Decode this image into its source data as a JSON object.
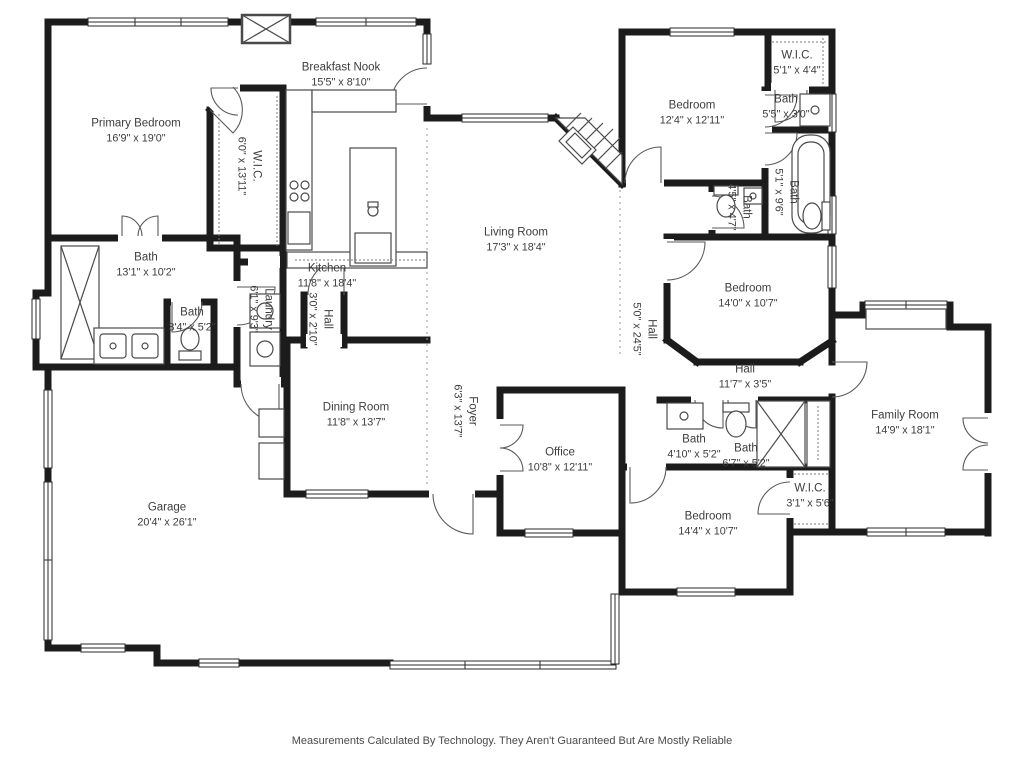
{
  "colors": {
    "background": "#ffffff",
    "walls": "#1c1c1c",
    "fixtures": "#4a4a4a",
    "text": "#3d3d3d"
  },
  "rooms": [
    {
      "name": "Primary Bedroom",
      "dims": "16'9\" x 19'0\"",
      "x": 136,
      "y": 131,
      "rotated": false
    },
    {
      "name": "W.I.C.",
      "dims": "6'0\" x 13'11\"",
      "x": 249,
      "y": 166,
      "rotated": true
    },
    {
      "name": "Breakfast Nook",
      "dims": "15'5\" x 8'10\"",
      "x": 341,
      "y": 75,
      "rotated": false
    },
    {
      "name": "Kitchen",
      "dims": "11'8\" x 18'4\"",
      "x": 327,
      "y": 276,
      "rotated": false
    },
    {
      "name": "Living Room",
      "dims": "17'3\" x 18'4\"",
      "x": 516,
      "y": 240,
      "rotated": false
    },
    {
      "name": "Bedroom",
      "dims": "12'4\" x 12'11\"",
      "x": 692,
      "y": 113,
      "rotated": false
    },
    {
      "name": "W.I.C.",
      "dims": "5'1\" x 4'4\"",
      "x": 797,
      "y": 63,
      "rotated": false
    },
    {
      "name": "Bath",
      "dims": "5'5\" x 3'0\"",
      "x": 786,
      "y": 107,
      "rotated": false
    },
    {
      "name": "Bath",
      "dims": "5'1\" x 9'6\"",
      "x": 786,
      "y": 192,
      "rotated": true
    },
    {
      "name": "Bath",
      "dims": "4'5\" x 4'7\"",
      "x": 739,
      "y": 207,
      "rotated": true
    },
    {
      "name": "Bedroom",
      "dims": "14'0\" x 10'7\"",
      "x": 748,
      "y": 296,
      "rotated": false
    },
    {
      "name": "Hall",
      "dims": "5'0\" x 24'5\"",
      "x": 644,
      "y": 329,
      "rotated": true
    },
    {
      "name": "Hall",
      "dims": "11'7\" x 3'5\"",
      "x": 745,
      "y": 377,
      "rotated": false
    },
    {
      "name": "Family Room",
      "dims": "14'9\" x 18'1\"",
      "x": 905,
      "y": 423,
      "rotated": false
    },
    {
      "name": "Bath",
      "dims": "4'10\" x 5'2\"",
      "x": 694,
      "y": 447,
      "rotated": false
    },
    {
      "name": "Bath",
      "dims": "6'7\" x 5'2\"",
      "x": 746,
      "y": 456,
      "rotated": false
    },
    {
      "name": "W.I.C.",
      "dims": "3'1\" x 5'6\"",
      "x": 810,
      "y": 496,
      "rotated": false
    },
    {
      "name": "Bedroom",
      "dims": "14'4\" x 10'7\"",
      "x": 708,
      "y": 524,
      "rotated": false
    },
    {
      "name": "Office",
      "dims": "10'8\" x 12'11\"",
      "x": 560,
      "y": 460,
      "rotated": false
    },
    {
      "name": "Foyer",
      "dims": "6'3\" x 13'7\"",
      "x": 465,
      "y": 411,
      "rotated": true
    },
    {
      "name": "Dining Room",
      "dims": "11'8\" x 13'7\"",
      "x": 356,
      "y": 415,
      "rotated": false
    },
    {
      "name": "Bath",
      "dims": "13'1\" x 10'2\"",
      "x": 146,
      "y": 265,
      "rotated": false
    },
    {
      "name": "Bath",
      "dims": "3'4\" x 5'2\"",
      "x": 192,
      "y": 320,
      "rotated": false
    },
    {
      "name": "Laundry",
      "dims": "6'1\" x 9'3\"",
      "x": 261,
      "y": 309,
      "rotated": true
    },
    {
      "name": "Hall",
      "dims": "3'0\" x 2'10\"",
      "x": 320,
      "y": 319,
      "rotated": true
    },
    {
      "name": "Garage",
      "dims": "20'4\" x 26'1\"",
      "x": 167,
      "y": 515,
      "rotated": false
    }
  ],
  "footer": {
    "disclaimer": "Measurements Calculated By Technology. They Aren't Guaranteed But Are Mostly Reliable"
  }
}
